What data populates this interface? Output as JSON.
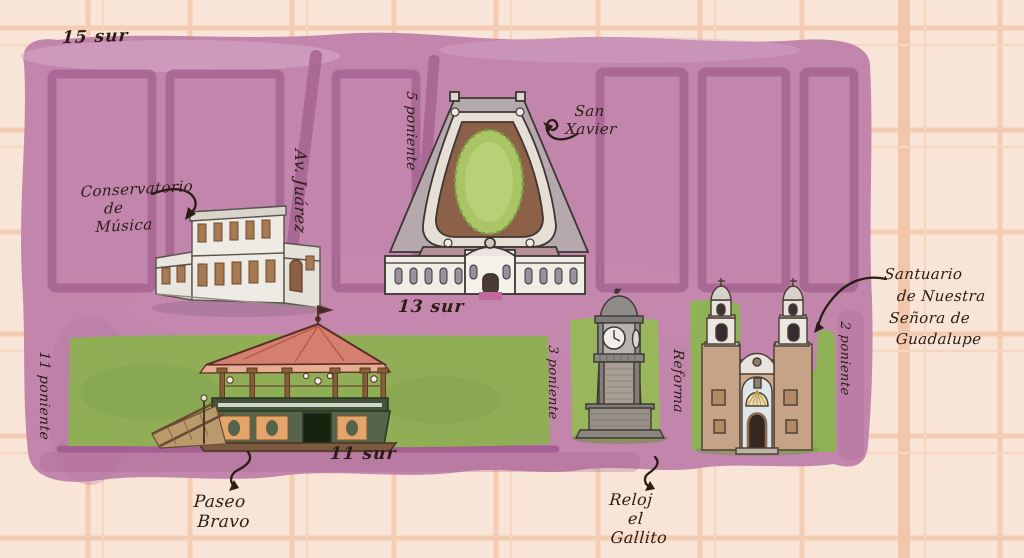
{
  "streets": {
    "sur_15": "15 sur",
    "av_juarez": "Av. Juárez",
    "poniente_5": "5 poniente",
    "sur_13": "13 sur",
    "poniente_11": "11 poniente",
    "sur_11": "11 sur",
    "poniente_3": "3 poniente",
    "reforma": "Reforma",
    "poniente_2": "2 poniente"
  },
  "landmarks": {
    "conservatorio": {
      "l1": "Conservatorio",
      "l2": "de",
      "l3": "Música"
    },
    "san_xavier": {
      "l1": "San",
      "l2": "Xavier"
    },
    "paseo_bravo": {
      "l1": "Paseo",
      "l2": "Bravo"
    },
    "reloj_el_gallito": {
      "l1": "Reloj",
      "l2": "el",
      "l3": "Gallito"
    },
    "santuario": {
      "l1": "Santuario",
      "l2": "de Nuestra",
      "l3": "Señora de",
      "l4": "Guadalupe"
    }
  },
  "colors": {
    "background": "#f8e5d7",
    "grid": "#f3ccb2",
    "district": "#c286ad",
    "district_street": "#a4608f",
    "park": "#8fae56",
    "ink": "#2b1d14",
    "kiosk_roof": "#d5806f",
    "building_stone": "#e9e6df"
  }
}
